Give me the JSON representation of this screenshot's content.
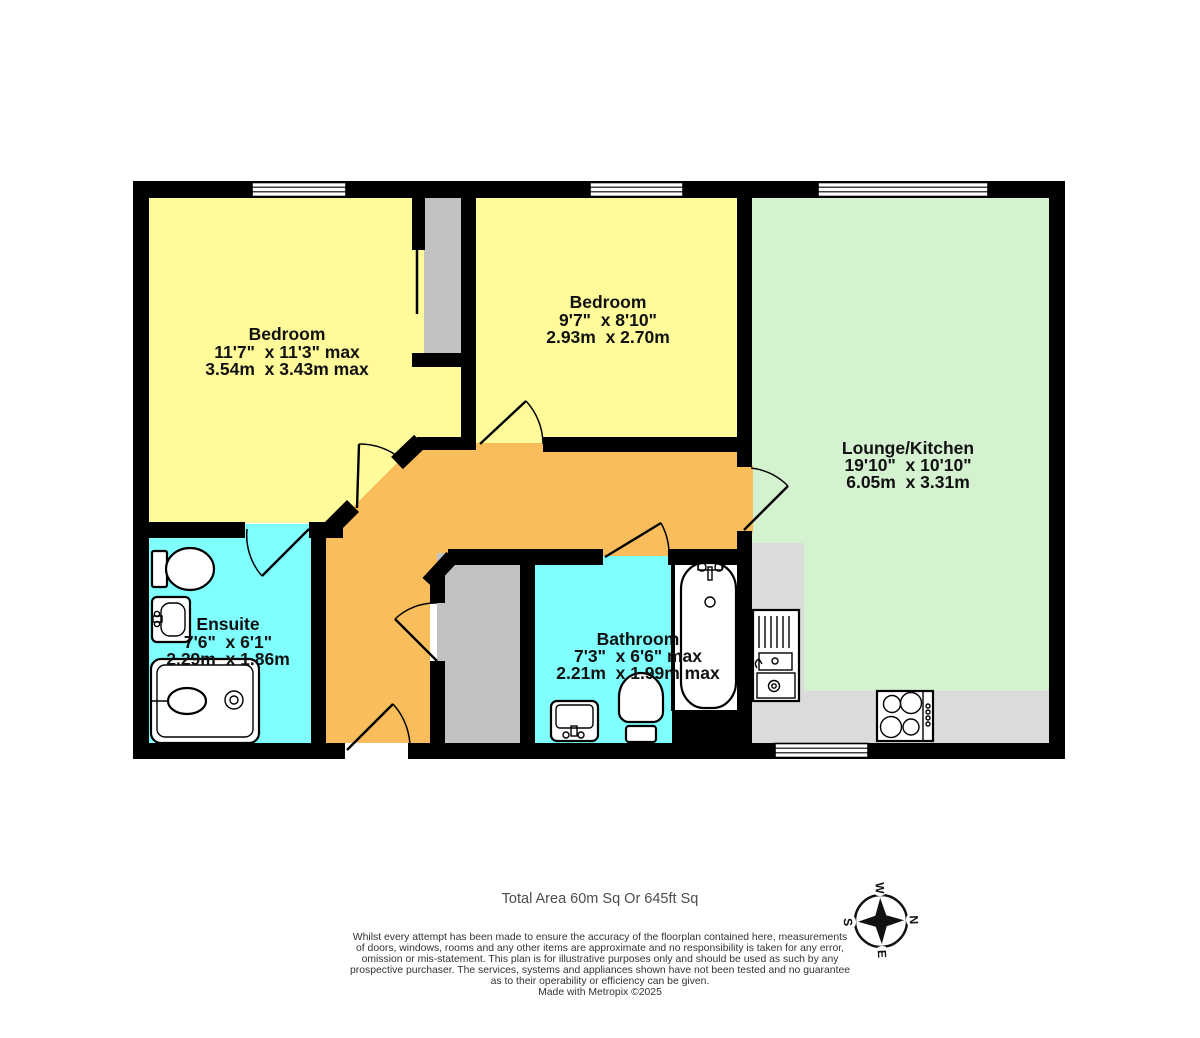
{
  "floorplan": {
    "rooms": [
      {
        "id": "bedroom-1",
        "name": "Bedroom",
        "size_imperial": "11'7\"  x 11'3\" max",
        "size_metric": "3.54m  x 3.43m max"
      },
      {
        "id": "bedroom-2",
        "name": "Bedroom",
        "size_imperial": "9'7\"  x 8'10\"",
        "size_metric": "2.93m  x 2.70m"
      },
      {
        "id": "lounge-kitchen",
        "name": "Lounge/Kitchen",
        "size_imperial": "19'10\"  x 10'10\"",
        "size_metric": "6.05m  x 3.31m"
      },
      {
        "id": "ensuite",
        "name": "Ensuite",
        "size_imperial": "7'6\"  x 6'1\"",
        "size_metric": "2.29m  x 1.86m"
      },
      {
        "id": "bathroom",
        "name": "Bathroom",
        "size_imperial": "7'3\"  x 6'6\" max",
        "size_metric": "2.21m  x 1.99m max"
      }
    ],
    "compass": {
      "n": "N",
      "e": "E",
      "s": "S",
      "w": "W"
    },
    "colors": {
      "bedroom": "#FFFB9B",
      "lounge_kitchen": "#D4F2D0",
      "wet_room": "#80FFFF",
      "hallway": "#F9BE5B",
      "closet": "#C2C2C2",
      "counter": "#DBDBDB",
      "wall": "#000000"
    }
  },
  "footer": {
    "total_area": "Total Area 60m Sq Or 645ft Sq",
    "disclaimer_lines": [
      "Whilst every attempt has been made to ensure the accuracy of the floorplan contained here, measurements",
      "of doors, windows, rooms and any other items are approximate and no responsibility is taken for any error,",
      "omission or mis-statement. This plan is for illustrative purposes only and should be used as such by any",
      "prospective purchaser. The services, systems and appliances shown have not been tested and no guarantee",
      "as to their operability or efficiency can be given."
    ],
    "credit": "Made with Metropix ©2025"
  }
}
